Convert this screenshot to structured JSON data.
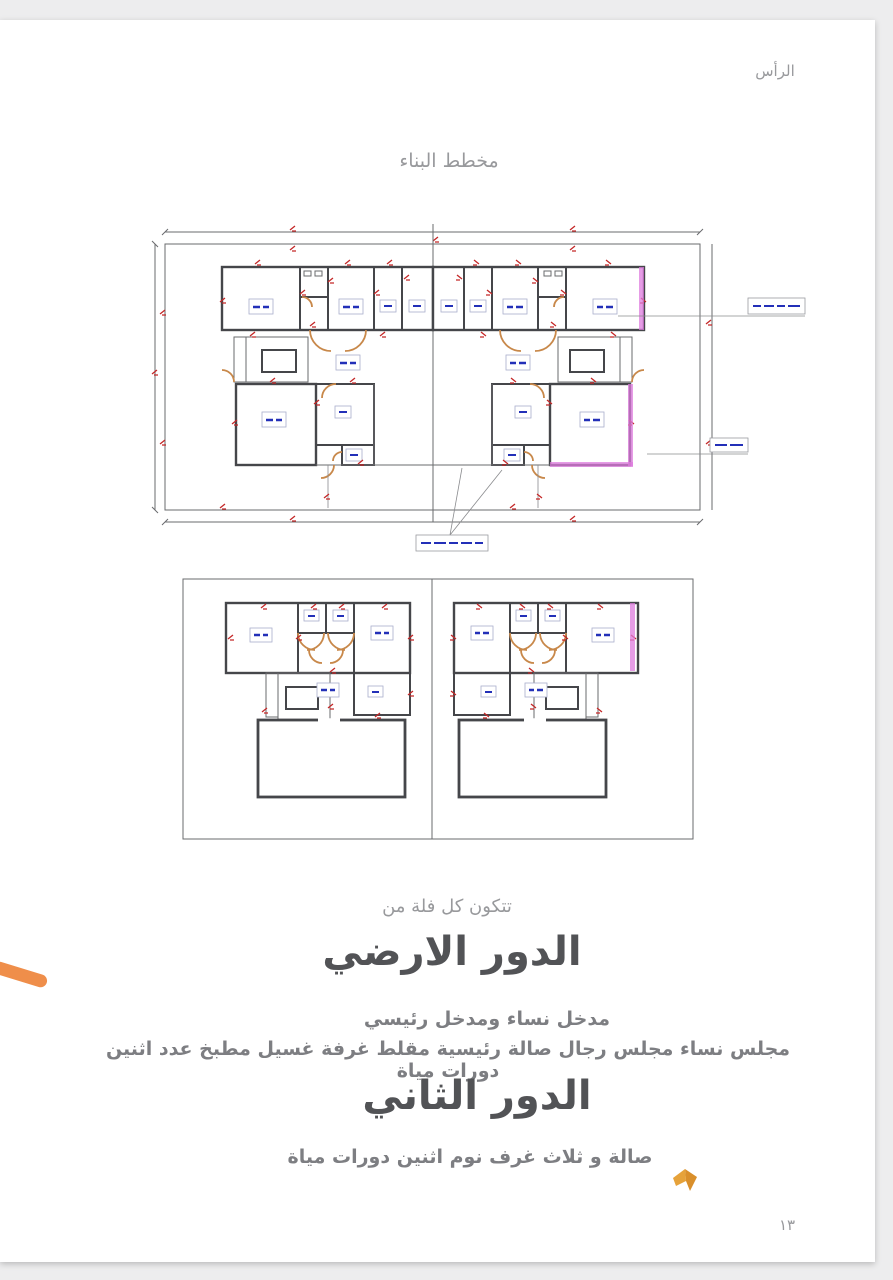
{
  "document": {
    "header_note": "الرأس",
    "title": "مخطط البناء",
    "intro": "تتكون كل فلة من",
    "ground_floor": {
      "heading": "الدور الارضي",
      "line1": "مدخل نساء ومدخل رئيسي",
      "line2": "مجلس نساء مجلس رجال صالة رئيسية مقلط غرفة غسيل مطبخ عدد اثنين دورات مياة"
    },
    "second_floor": {
      "heading": "الدور الثاني",
      "line1": "صالة و ثلاث غرف نوم اثنين دورات مياة"
    },
    "page_number": "١٣"
  },
  "colors": {
    "page_bg": "#ffffff",
    "viewer_bg": "#ededee",
    "plan_line": "#45464a",
    "dimension_red": "#c42727",
    "label_blue": "#2330b8",
    "door_tan": "#c8884a",
    "highlight_magenta": "#dd7bdd",
    "text_grey": "#7d7e82",
    "heading_grey": "#525356",
    "muted_grey": "#98999c",
    "marker_orange": "#ef8e4a",
    "bookmark_amber": "#e6a23a"
  }
}
